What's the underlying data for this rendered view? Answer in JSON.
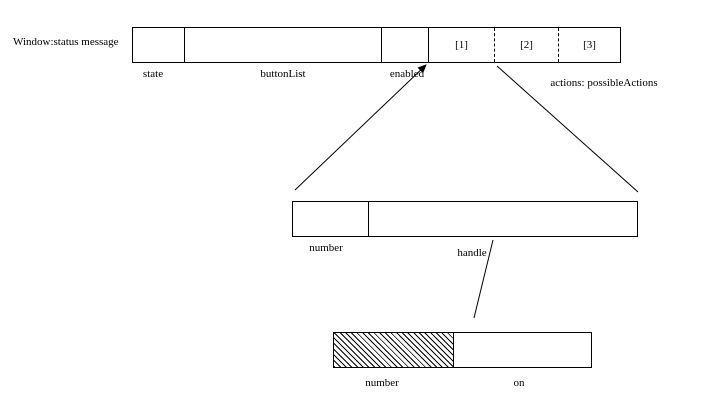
{
  "colors": {
    "background": "#ffffff",
    "ink": "#000000"
  },
  "window_record": {
    "title": "Window:status message",
    "fields": {
      "state_label": "state",
      "button_list_label": "buttonList",
      "enabled_label": "enabled",
      "actions_label": "actions: possibleActions"
    },
    "action_slots": [
      "[1]",
      "[2]",
      "[3]"
    ]
  },
  "button_record": {
    "fields": {
      "number_label": "number",
      "handle_label": "handle"
    }
  },
  "handle_record": {
    "fields": {
      "number_label": "number",
      "on_label": "on"
    }
  }
}
